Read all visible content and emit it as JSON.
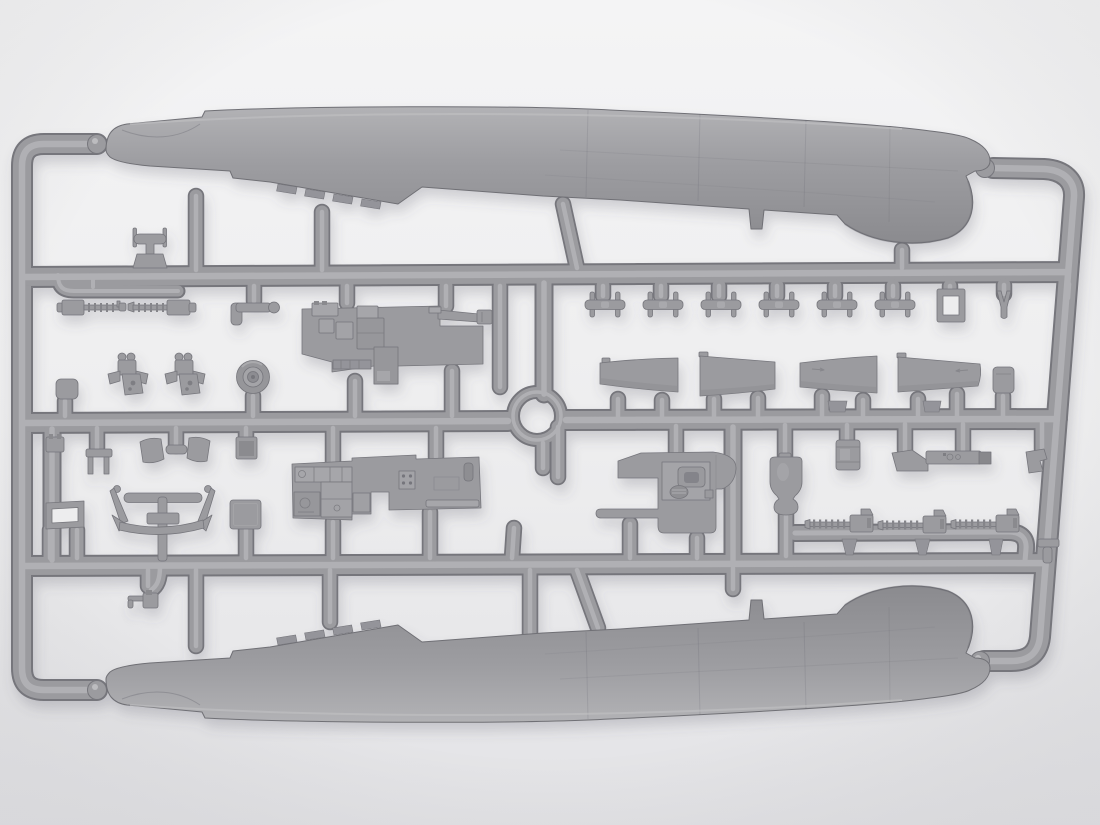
{
  "scene": {
    "type": "photograph",
    "subject": "Injection-molded light-gray plastic model aircraft kit sprue (parts frame)",
    "background": "plain light studio backdrop with soft shadows",
    "orientation": "horizontal rectangular runner frame, large fuselage halves along top and bottom edges"
  },
  "colors": {
    "bg_top": "#f4f4f5",
    "bg_mid": "#eeeeef",
    "bg_bottom": "#e3e3e6",
    "vignette": "#d8d8db",
    "plastic_base": "#9b9b9f",
    "plastic_light": "#b3b3b6",
    "plastic_highlight": "#b8b8bb",
    "plastic_mid": "#9d9da1",
    "plastic_dark": "#8a8a8e",
    "plastic_deep": "#7e7e83",
    "plastic_edge": "#76767c",
    "hole": "#ededee",
    "shadow": "#565660"
  },
  "sprue": {
    "frame": {
      "horizontal_runners": 3,
      "vertical_side_runners": 2,
      "center_junction": "circular ring",
      "corner_style": "rounded with ball-shaped gates at fuselage noses"
    },
    "parts_inventory": [
      {
        "name": "fuselage-half",
        "qty": 2
      },
      {
        "name": "tailplane-blade",
        "qty": 4
      },
      {
        "name": "interplane-strut",
        "qty": 6
      },
      {
        "name": "machine-gun-pair",
        "qty": 2
      },
      {
        "name": "machine-gun-on-rack",
        "qty": 3
      },
      {
        "name": "main-wheel",
        "qty": 1
      },
      {
        "name": "cockpit-floor-assembly",
        "qty": 1
      },
      {
        "name": "radio-instrument-deck",
        "qty": 1
      },
      {
        "name": "cockpit-sidewall",
        "qty": 1
      },
      {
        "name": "bell-shaped-fairing",
        "qty": 1
      },
      {
        "name": "window-frame",
        "qty": 1
      },
      {
        "name": "square-frame",
        "qty": 1
      },
      {
        "name": "strut-frame-assembly",
        "qty": 1
      },
      {
        "name": "mount-bracket",
        "qty": 2
      },
      {
        "name": "cowl-panel",
        "qty": 2
      },
      {
        "name": "small-detail-parts",
        "qty": 14
      }
    ]
  }
}
